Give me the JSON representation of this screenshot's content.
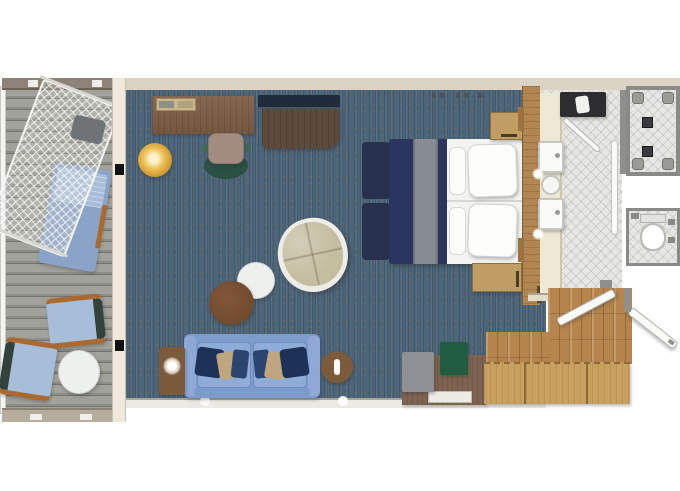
{
  "title": "Cruise suite floor plan (top-down)",
  "palette": {
    "page-bg": "#ffffff",
    "carpet": "#4b657a",
    "deck-light": "#a2a29c",
    "deck-dark": "#75756d",
    "wall-cream": "#dbd3c4",
    "wall-edge": "#948c7c",
    "wall-gray": "#8f8f8b",
    "divider": "#efe9dc",
    "wood-desk": "#7c604a",
    "wood-dark": "#5c4a3b",
    "tv-navy": "#1f2a3a",
    "gold": "#d9a437",
    "chair-teal": "#2b5044",
    "chair-seat": "#a28c7f",
    "papasan-shell": "#edece6",
    "papasan-cushion": "#c5bda0",
    "table-white": "#eef0ee",
    "table-brown": "#6f4a2d",
    "sofa": "#7e9ccc",
    "sofa-arm": "#8ea9d6",
    "pillow-navy": "#1c3257",
    "pillow-tan": "#c0a67f",
    "side-table": "#7c5a3c",
    "bed-navy": "#2b3660",
    "bed-stripe": "#878c93",
    "linen": "#f3f3f1",
    "bench-navy": "#28324f",
    "nightstand": "#bf9d63",
    "wardrobe-wood": "#b28651",
    "counter": "#eee8d5",
    "tile": "#e6e6e2",
    "tub": "#2d2d31",
    "fixture-gray": "#9a9a96",
    "drain": "#3a3a3e",
    "entry-wood": "#b5854d",
    "closet-wood": "#c9a05e",
    "closet-line": "#8a6a38",
    "dresser": "#7e6450",
    "gray-box": "#8d9095",
    "green-box": "#1f5c42",
    "door-white": "#fafaf8",
    "lounger-blue": "#8ba3c7",
    "cushion-blue": "#a7bedb",
    "deck-chair-arm": "#a9692f",
    "toilet-white": "#ffffff"
  },
  "rooms": {
    "balcony": {
      "label": "balcony"
    },
    "living": {
      "label": "living room"
    },
    "bedroom": {
      "label": "bedroom"
    },
    "bathroom": {
      "label": "bathroom"
    },
    "shower": {
      "label": "shower room"
    },
    "wc": {
      "label": "toilet room"
    },
    "entry": {
      "label": "entry hall"
    }
  },
  "furniture": {
    "balcony": [
      "hammock",
      "sun lounger",
      "deck chair",
      "deck chair",
      "round table"
    ],
    "living": [
      "desk with trays",
      "desk chair",
      "tv cabinet",
      "tv",
      "gold ottoman",
      "round lounge chair",
      "white coffee table",
      "brown coffee table",
      "sofa with pillows",
      "side table with lamp",
      "side table with lamp"
    ],
    "bedroom": [
      "double bed",
      "foot bench",
      "nightstand",
      "nightstand",
      "dresser",
      "stool",
      "tray"
    ],
    "bathroom": [
      "double vanity",
      "sink",
      "sink",
      "bathtub",
      "glass shower door"
    ],
    "shower": [
      "shower drains",
      "corner fixtures"
    ],
    "wc": [
      "toilet"
    ],
    "entry": [
      "wardrobe closets",
      "interior door",
      "entry door"
    ]
  }
}
